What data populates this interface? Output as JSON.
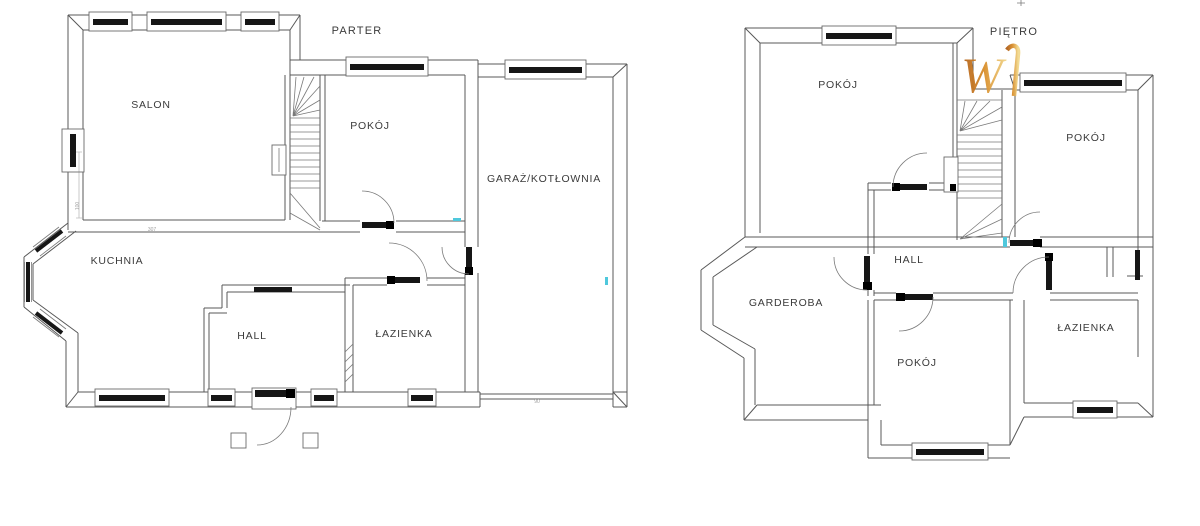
{
  "colors": {
    "wall_line": "#585858",
    "fixture_dark": "#161616",
    "accent_cyan": "#4fc8dc",
    "watermark_gold_dark": "#b05f1a",
    "watermark_gold_mid": "#d98e2b",
    "watermark_gold_light": "#f2d98e",
    "label_text": "#3b3b3b",
    "dim_text": "#a0a0a0"
  },
  "parter": {
    "label": "PARTER",
    "rooms": {
      "salon": "SALON",
      "pokoj": "POKÓJ",
      "garaz": "GARAŻ/KOTŁOWNIA",
      "kuchnia": "KUCHNIA",
      "hall": "HALL",
      "lazienka": "ŁAZIENKA"
    },
    "dimensions": {
      "salon_width": "307",
      "salon_side": "100",
      "garage_door": "90"
    }
  },
  "pietro": {
    "label": "PIĘTRO",
    "rooms": {
      "pokoj_top_left": "POKÓJ",
      "pokoj_top_right": "POKÓJ",
      "hall": "HALL",
      "garderoba": "GARDEROBA",
      "pokoj_bottom": "POKÓJ",
      "lazienka": "ŁAZIENKA"
    }
  },
  "watermark": {
    "letter": "W"
  }
}
